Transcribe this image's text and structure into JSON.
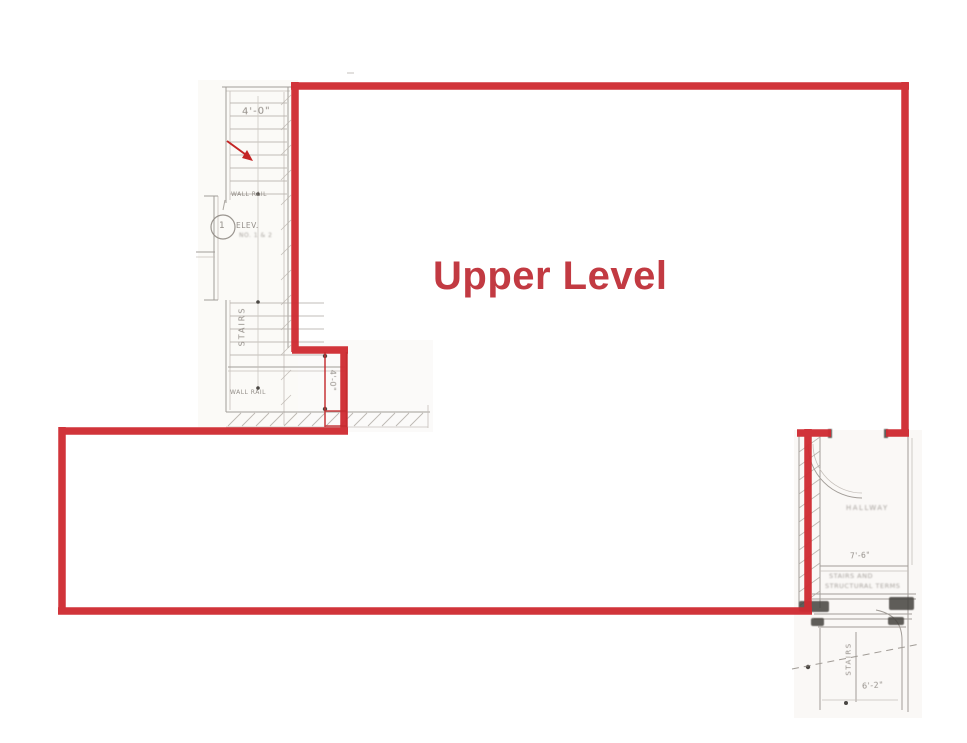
{
  "annotation": {
    "title": "Upper Level",
    "outline_color": "#d02c33",
    "title_color": "#c23a42"
  },
  "plan_labels": {
    "upper_stair_dim": "4'-0\"",
    "upper_wall_rail": "WALL RAIL",
    "elevator": "ELEV.",
    "elevator_note": "NO. 1 & 2",
    "detail_marker": "1",
    "upper_stairs": "STAIRS",
    "lower_wall_rail": "WALL RAIL",
    "step_dim": "4'-0\"",
    "hallway": "HALLWAY",
    "hallway_dim": "7'-6\"",
    "note_line1": "STAIRS AND",
    "note_line2": "STRUCTURAL TERMS",
    "lower_stairs": "STAIRS",
    "lower_stair_dim": "6'-2\""
  }
}
